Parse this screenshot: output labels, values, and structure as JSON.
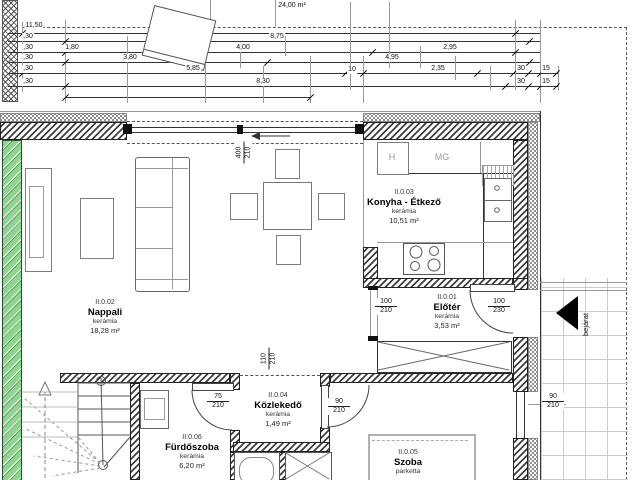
{
  "top_dims": {
    "terrace_area": "24,00 m²",
    "total": "11,50",
    "wall30": ",30",
    "len_875": "8,75",
    "len_180": "1,80",
    "len_400": "4,00",
    "len_295": "2,95",
    "len_380": "3,80",
    "len_495": "4,95",
    "len_585": "5,85",
    "len_10": "10",
    "len_235": "2,35",
    "len_30": "30",
    "len_15": "15",
    "len_830": "8,30"
  },
  "rooms": {
    "nappali": {
      "id": "II.0.02",
      "name": "Nappali",
      "material": "kerámia",
      "area": "18,28 m²"
    },
    "konyha": {
      "id": "II.0.03",
      "name": "Konyha - Étkező",
      "material": "kerámia",
      "area": "10,51 m²"
    },
    "eloter": {
      "id": "II.0.01",
      "name": "Előtér",
      "material": "kerámia",
      "area": "3,53 m²"
    },
    "kozlekedo": {
      "id": "II.0.04",
      "name": "Közlekedő",
      "material": "kerámia",
      "area": "1,49 m²"
    },
    "furdoszoba": {
      "id": "II.0.06",
      "name": "Fürdőszoba",
      "material": "kerámia",
      "area": "6,20 m²"
    },
    "szoba": {
      "id": "II.0.05",
      "name": "Szoba",
      "material": "parketta"
    }
  },
  "openings": {
    "window_main": {
      "w": "400",
      "h": "210"
    },
    "pass_living": {
      "w": "110",
      "h": "210"
    },
    "door_bath": {
      "w": "75",
      "h": "210"
    },
    "door_room": {
      "w": "90",
      "h": "210"
    },
    "open_hall": {
      "w": "100",
      "h": "210"
    },
    "door_entry": {
      "w": "100",
      "h": "230"
    },
    "door_side": {
      "w": "90",
      "h": "210"
    }
  },
  "kitchen": {
    "fridge_label": "H",
    "appliance_label": "MG"
  },
  "entrance_label": "bejárat",
  "colors": {
    "party_wall_green": "#90d492",
    "wall_hatch": "#3f3f3f",
    "line": "#333333"
  }
}
